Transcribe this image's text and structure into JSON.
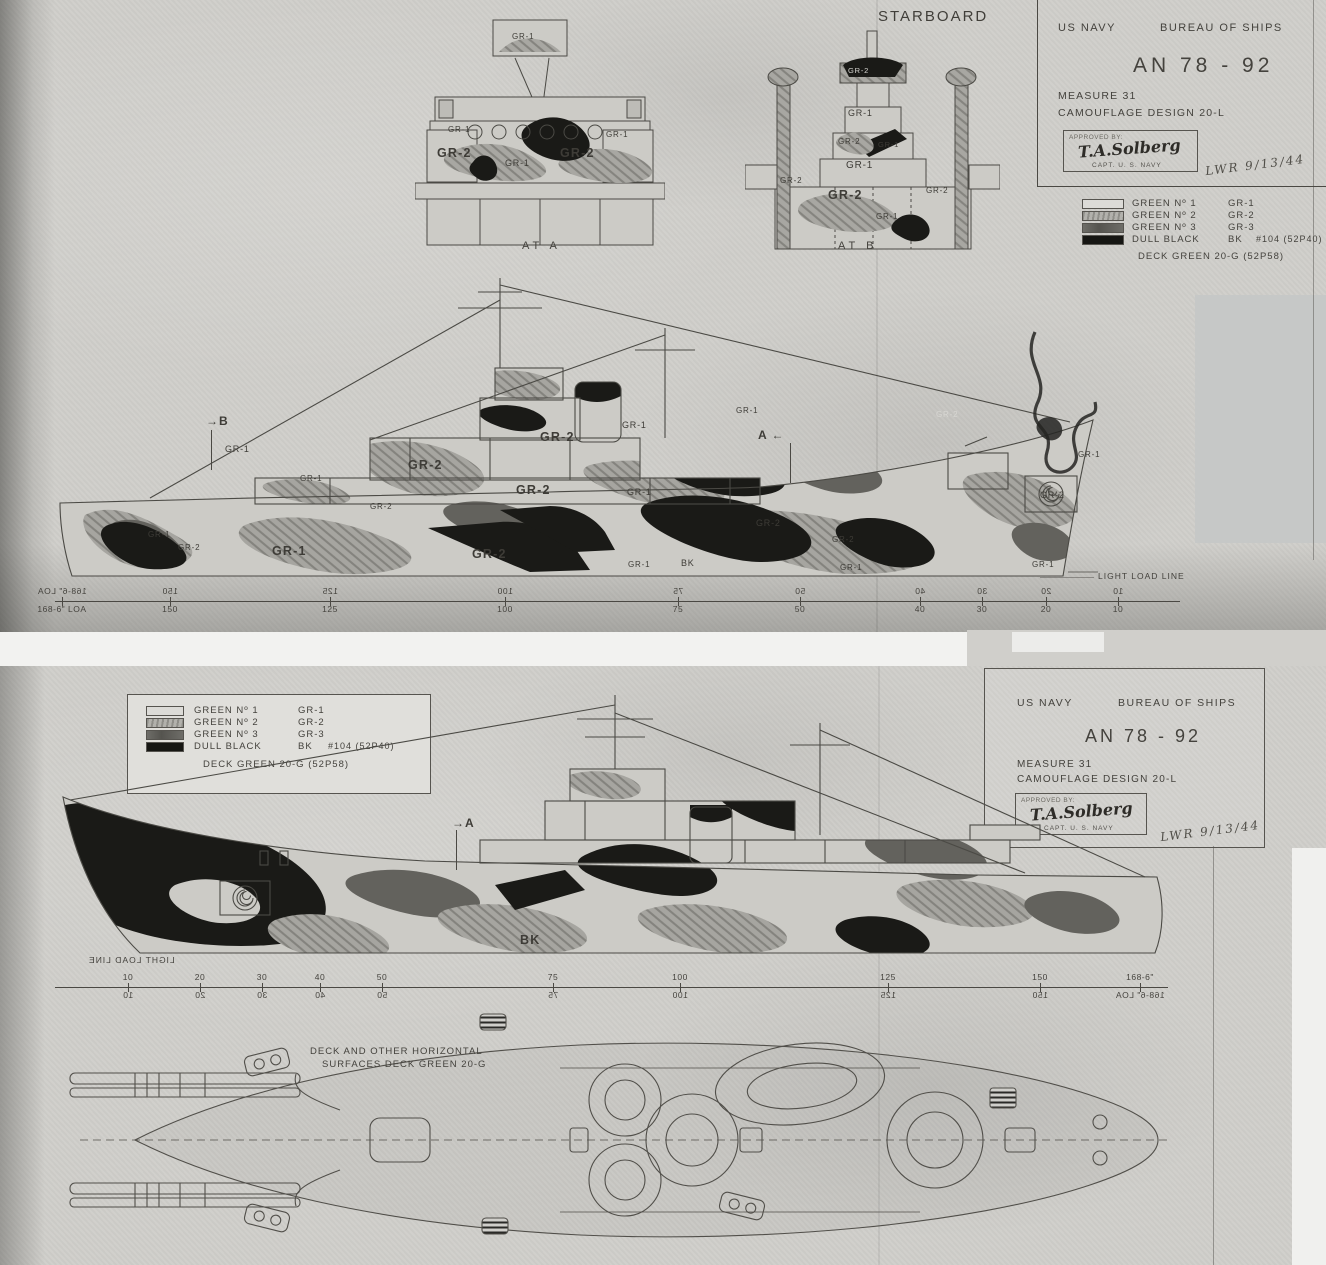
{
  "palette": {
    "paper": "#d0cfcb",
    "ink": "#4a4843",
    "gr1": "#cccbc6",
    "gr2_base": "#a5a49f",
    "gr3": "#63625d",
    "bk": "#1a1a17",
    "gray_patch": "#c6c8c7"
  },
  "shared": {
    "title_block": {
      "org_left": "US NAVY",
      "org_right": "BUREAU OF SHIPS",
      "drawing_no": "AN 78 - 92",
      "measure_line": "MEASURE  31",
      "design_line": "CAMOUFLAGE DESIGN  20-L",
      "approved_by": "APPROVED BY:",
      "signature": "T.A.Solberg",
      "sig_title": "CAPT. U. S. NAVY",
      "handwritten_note": "LWR  9/13/44"
    },
    "legend": {
      "rows": [
        {
          "name": "GREEN  Nº 1",
          "code": "GR-1",
          "extra": ""
        },
        {
          "name": "GREEN  Nº 2",
          "code": "GR-2",
          "extra": ""
        },
        {
          "name": "GREEN  Nº 3",
          "code": "GR-3",
          "extra": ""
        },
        {
          "name": "DULL BLACK",
          "code": "BK",
          "extra": "#104 (52P40)"
        }
      ],
      "deck_line": "DECK GREEN  20-G  (52P58)"
    },
    "paint_codes": {
      "gr1": "GR-1",
      "gr2": "GR-2",
      "gr3": "GR-3",
      "bk": "BK"
    },
    "waterline_label": "LIGHT LOAD LINE",
    "loa_full": "168-6\" LOA",
    "loa_short": "168-6\""
  },
  "top_sheet": {
    "view_label": "STARBOARD",
    "section_a_caption": "AT  A",
    "section_b_caption": "AT  B",
    "marker_b": "→B",
    "marker_a": "A ←",
    "scale_numbers": [
      "150",
      "125",
      "100",
      "75",
      "50",
      "40",
      "30",
      "20",
      "10"
    ]
  },
  "bottom_sheet": {
    "marker_a": "→A",
    "scale_numbers": [
      "10",
      "20",
      "30",
      "40",
      "50",
      "75",
      "100",
      "125",
      "150"
    ],
    "deck_note_line1": "DECK AND OTHER HORIZONTAL",
    "deck_note_line2": "SURFACES   DECK GREEN   20-G"
  }
}
